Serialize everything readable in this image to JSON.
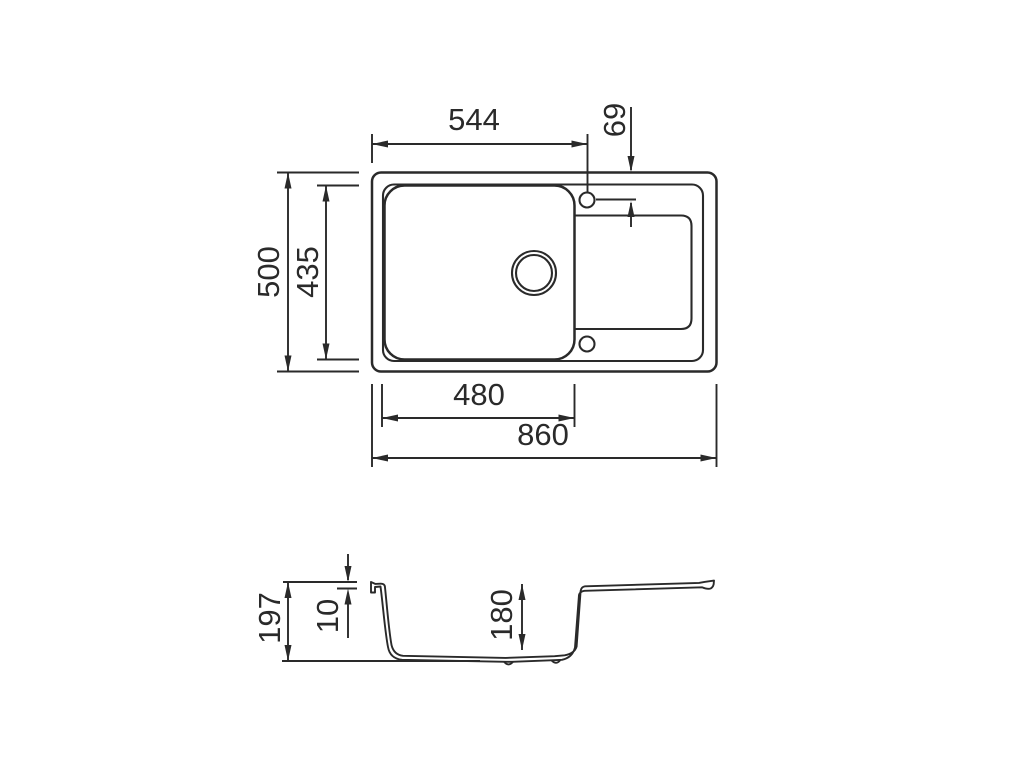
{
  "drawing": {
    "title": "sink-dimension-drawing",
    "views": [
      "top-view",
      "section-view"
    ],
    "style": {
      "line_color": "#2a2a2a",
      "background": "#ffffff"
    }
  },
  "dimensions": {
    "top_view": {
      "tap_hole_from_left": "544",
      "tap_hole_from_top": "69",
      "overall_depth": "500",
      "bowl_depth": "435",
      "bowl_width": "480",
      "overall_width": "860"
    },
    "section_view": {
      "overall_height": "197",
      "rim_height": "10",
      "bowl_depth": "180"
    }
  }
}
